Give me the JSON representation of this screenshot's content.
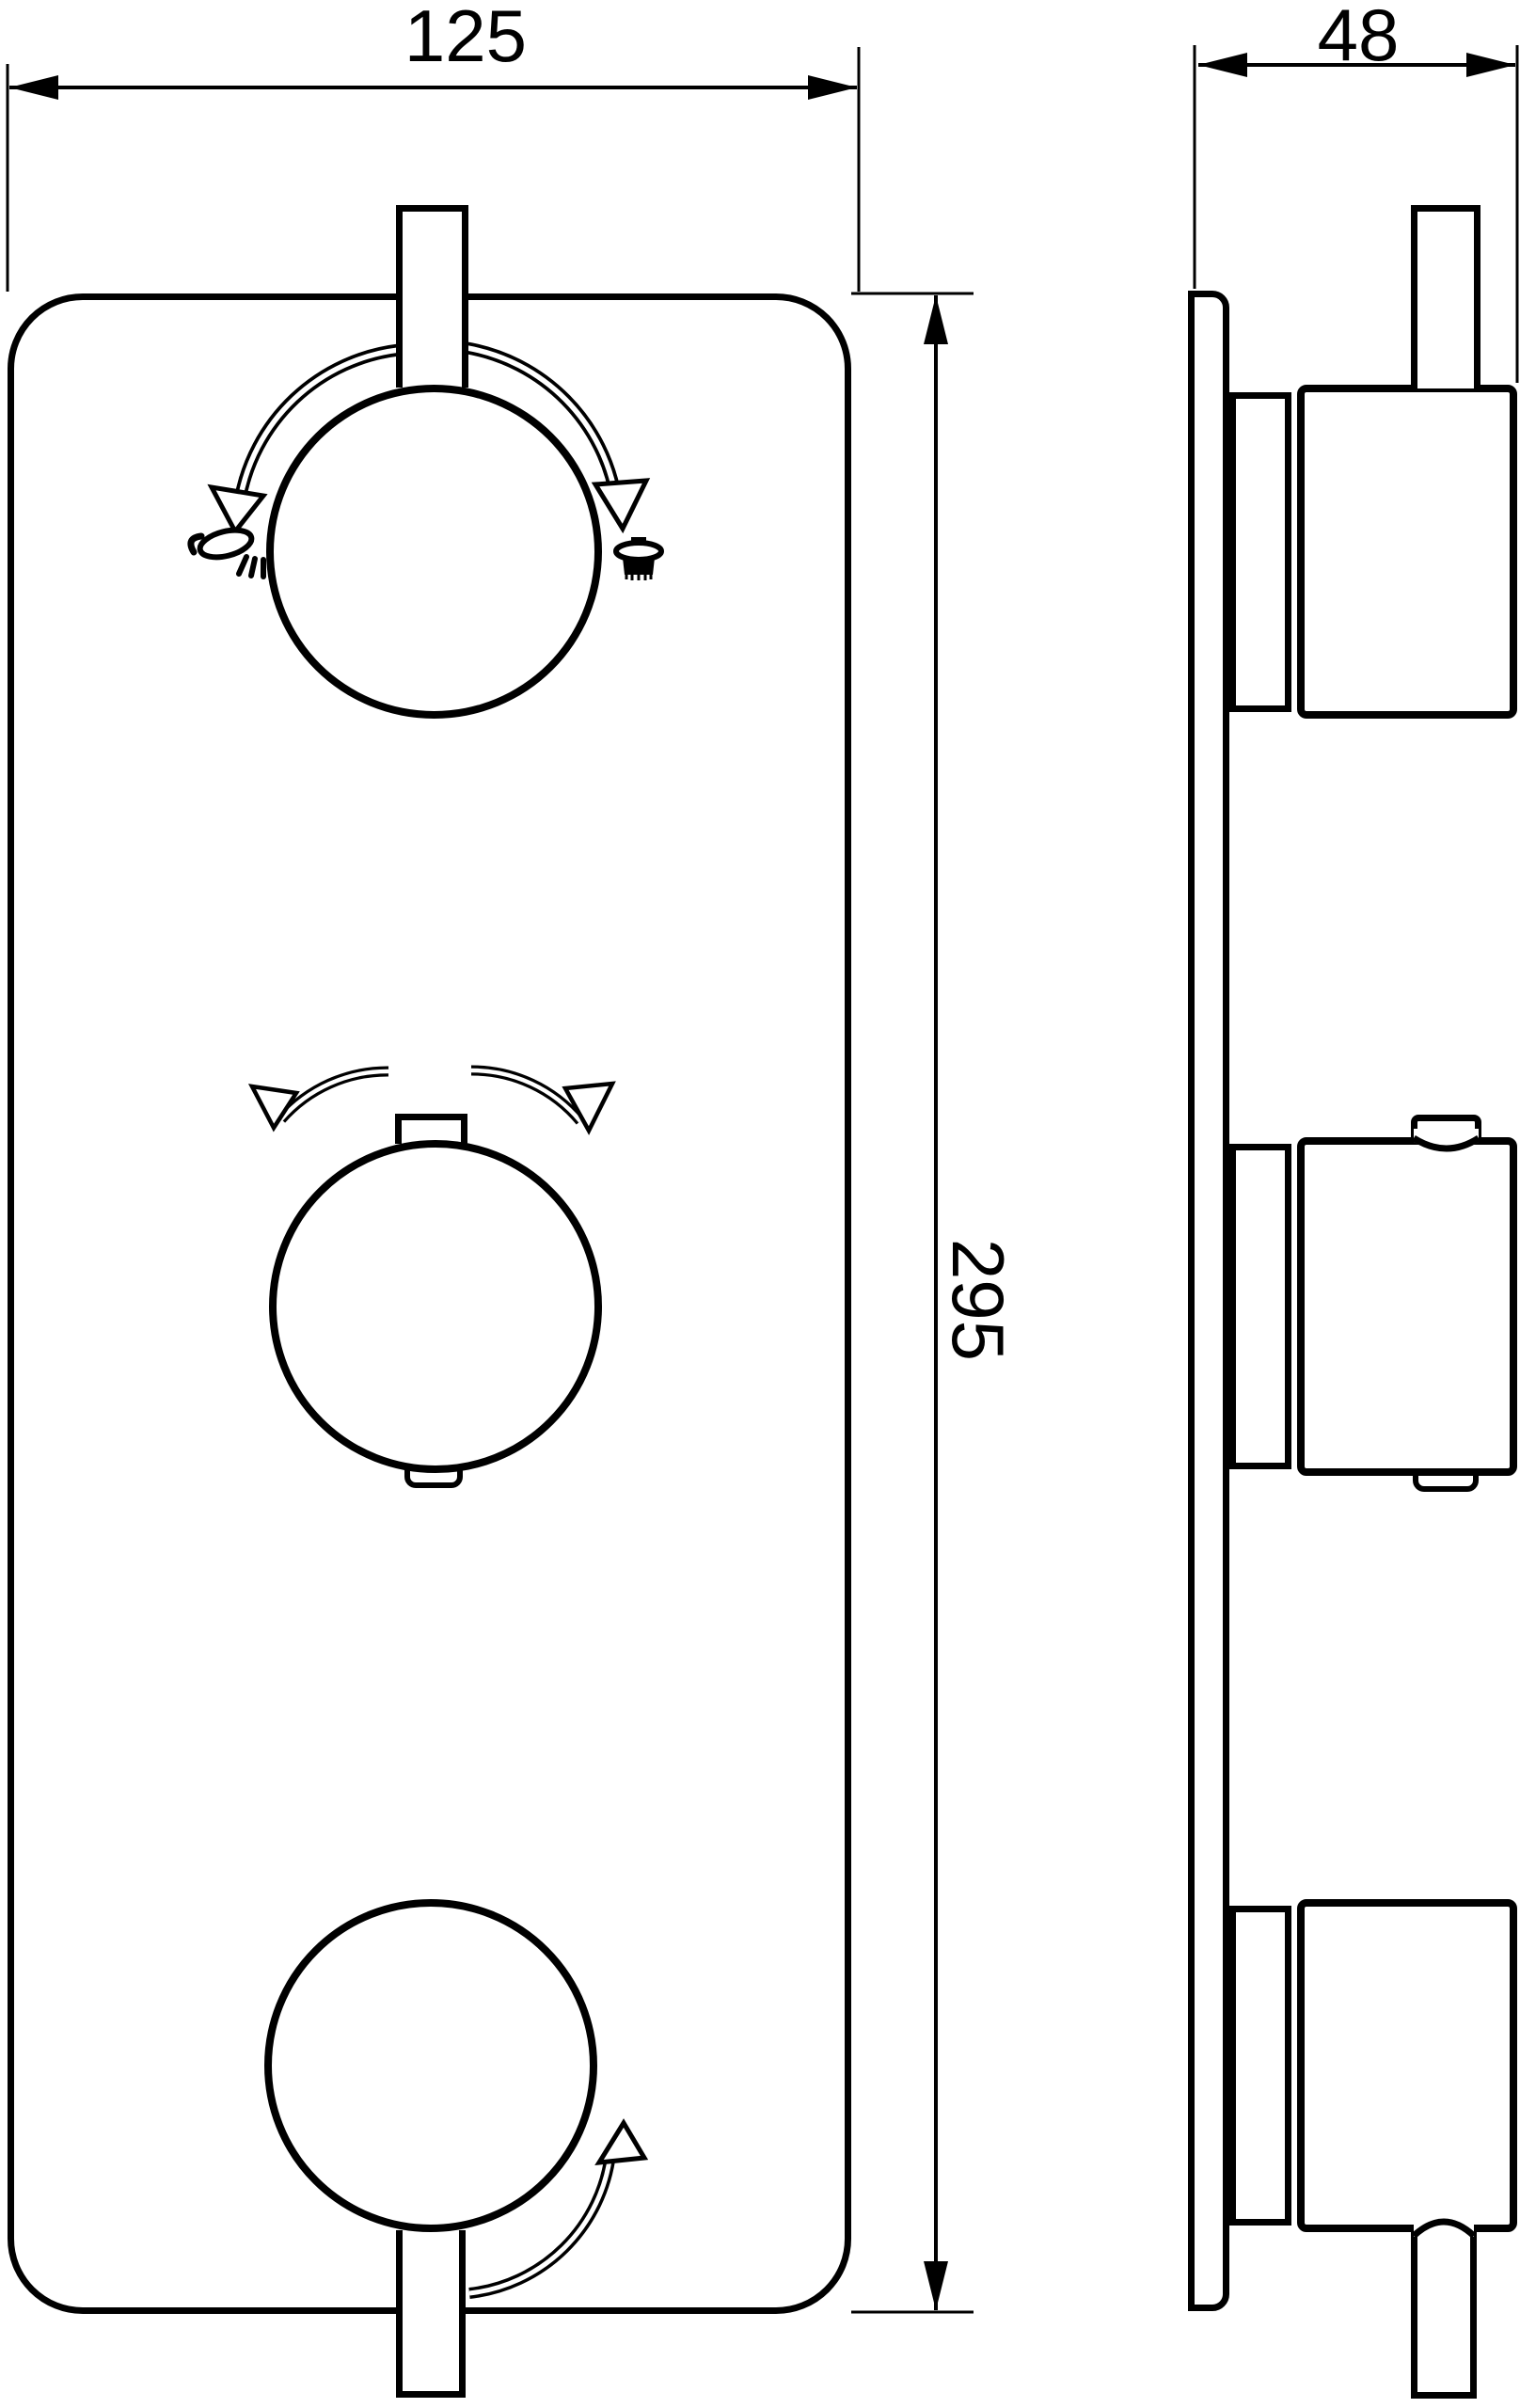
{
  "front_view": {
    "width_dim": "125",
    "height_dim": "295",
    "temperature_label": "38",
    "hot_label": "HOT",
    "cold_label": "COLD",
    "on_label": "ON"
  },
  "side_view": {
    "depth_dim": "48"
  },
  "icons": {
    "diverter_left": "handshower-icon",
    "diverter_right": "rainshower-icon"
  },
  "colors": {
    "line": "#000000",
    "background": "#ffffff"
  }
}
